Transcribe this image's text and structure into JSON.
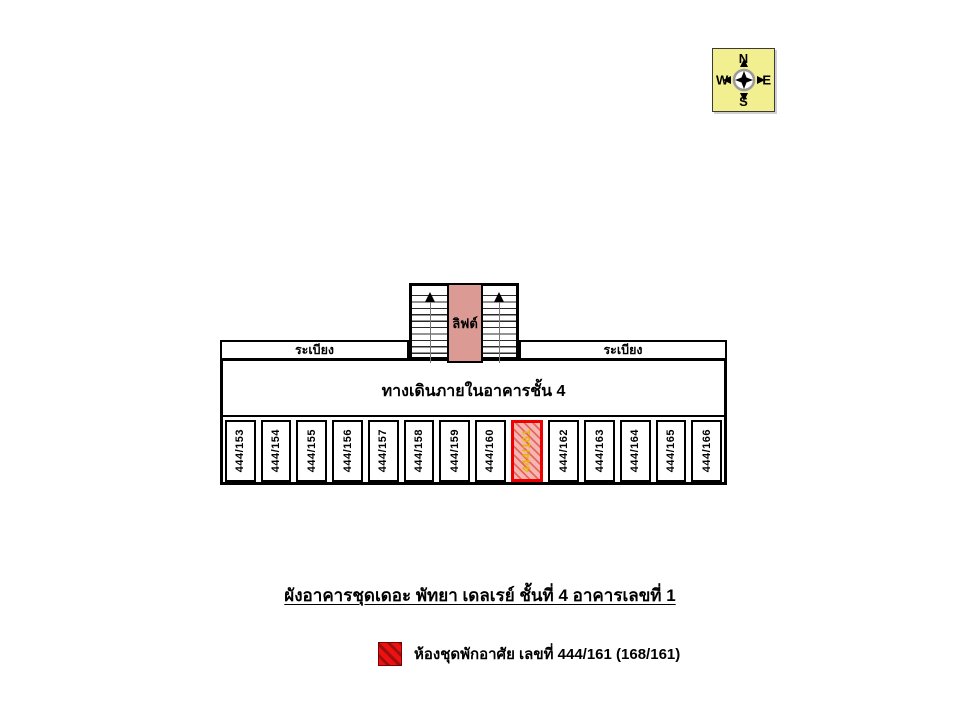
{
  "compass": {
    "north": "N",
    "south": "S",
    "east": "E",
    "west": "W",
    "bg_color": "#f2ef90"
  },
  "plan": {
    "elevator_label": "ลิฟต์",
    "balcony_left_label": "ระเบียง",
    "balcony_right_label": "ระเบียง",
    "corridor_label": "ทางเดินภายในอาคารชั้น 4",
    "rooms": [
      {
        "number": "444/153",
        "highlighted": false
      },
      {
        "number": "444/154",
        "highlighted": false
      },
      {
        "number": "444/155",
        "highlighted": false
      },
      {
        "number": "444/156",
        "highlighted": false
      },
      {
        "number": "444/157",
        "highlighted": false
      },
      {
        "number": "444/158",
        "highlighted": false
      },
      {
        "number": "444/159",
        "highlighted": false
      },
      {
        "number": "444/160",
        "highlighted": false
      },
      {
        "number": "444/161",
        "highlighted": true
      },
      {
        "number": "444/162",
        "highlighted": false
      },
      {
        "number": "444/163",
        "highlighted": false
      },
      {
        "number": "444/164",
        "highlighted": false
      },
      {
        "number": "444/165",
        "highlighted": false
      },
      {
        "number": "444/166",
        "highlighted": false
      }
    ],
    "colors": {
      "elevator_fill": "#db9a94",
      "highlight_border": "#ee0000",
      "highlight_fill": "#f5b5b0",
      "highlight_stripe": "#e0685f",
      "highlight_text": "#e6b400",
      "legend_red": "#ee1111",
      "wall": "#000000"
    }
  },
  "title": "ผังอาคารชุดเดอะ พัทยา เดลเรย์ ชั้นที่ 4  อาคารเลขที่ 1",
  "legend": {
    "label": "ห้องชุดพักอาศัย เลขที่ 444/161 (168/161)"
  }
}
